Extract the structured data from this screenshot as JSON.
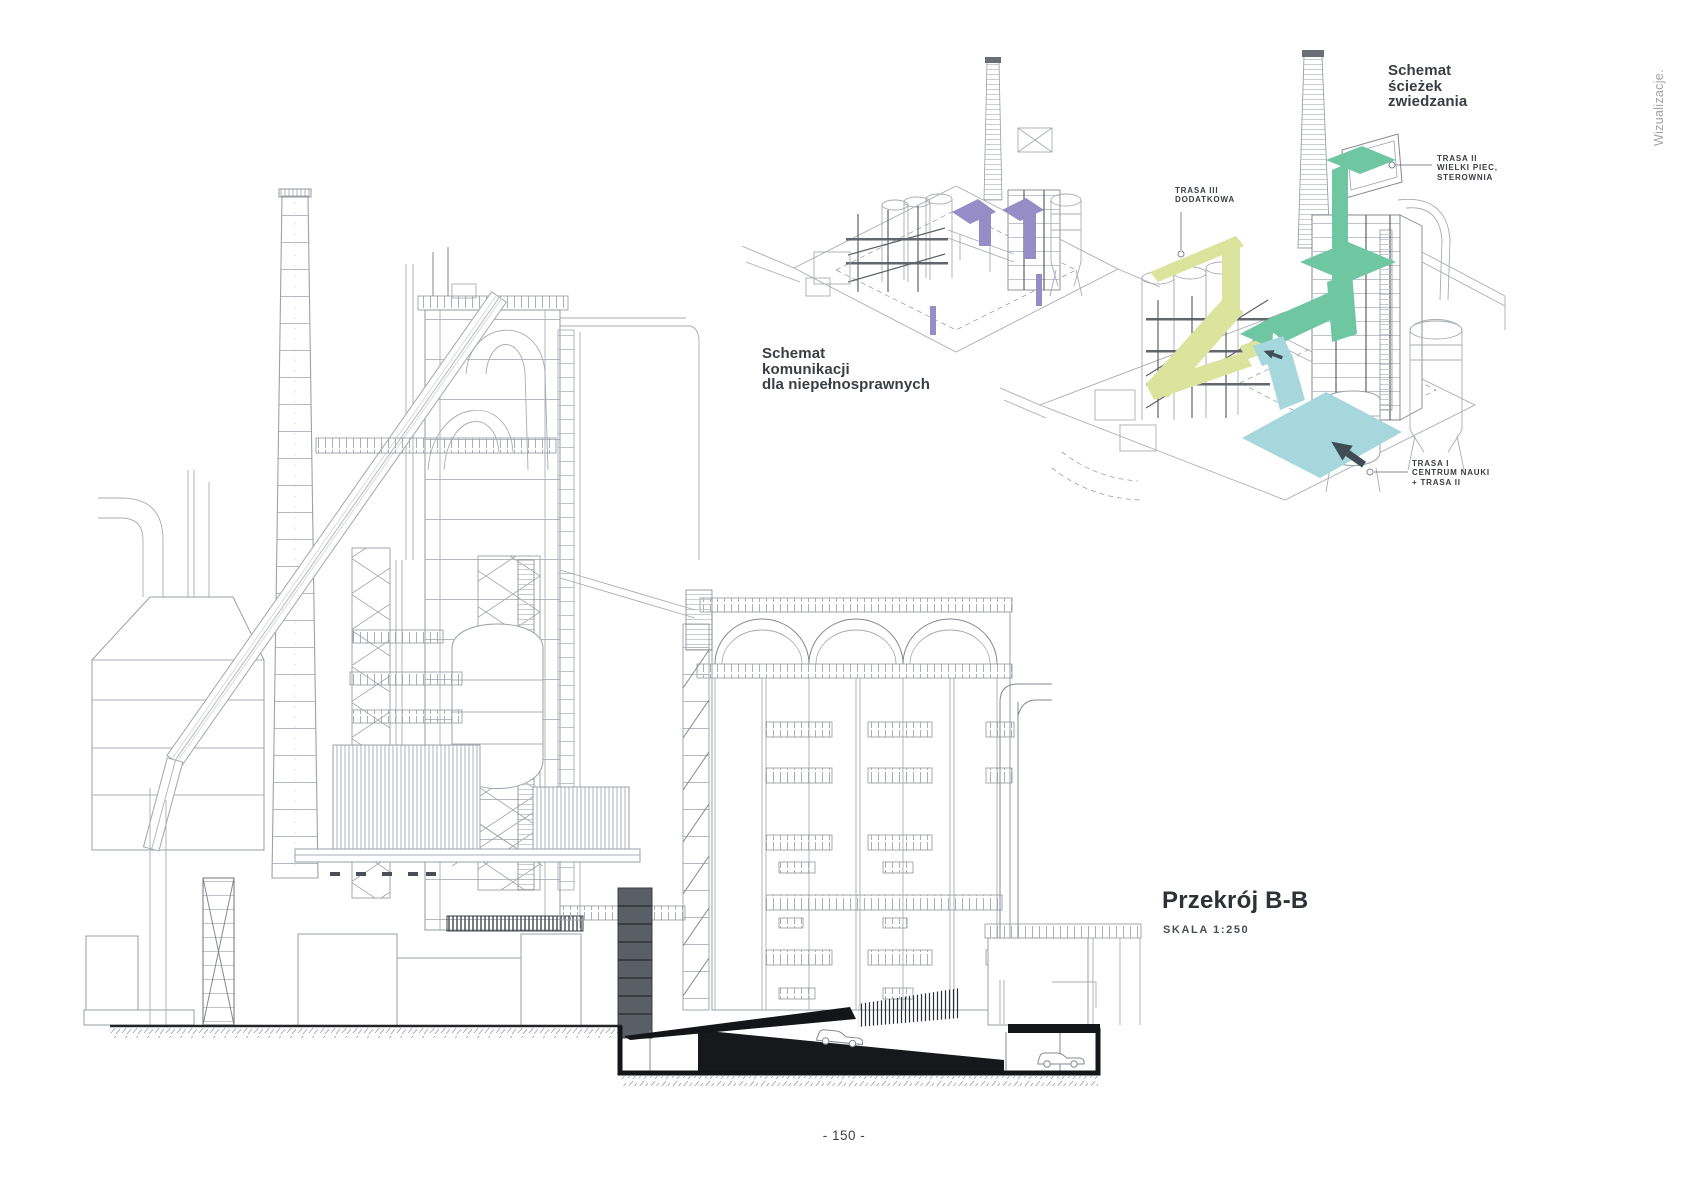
{
  "page": {
    "side_label": "Wizualizacje.",
    "page_number": "- 150 -",
    "background": "#ffffff"
  },
  "section_drawing": {
    "title": "Przekrój B-B",
    "scale_label": "SKALA 1:250"
  },
  "diagrams": {
    "accessibility": {
      "title_lines": [
        "Schemat",
        "komunikacji",
        "dla niepełnosprawnych"
      ],
      "accent_color": "#968dc6"
    },
    "tour": {
      "title_lines": [
        "Schemat",
        "ścieżek",
        "zwiedzania"
      ],
      "callouts": [
        {
          "id": "trasa-iii",
          "lines": [
            "TRASA III",
            "DODATKOWA"
          ],
          "color": "#dbe49c"
        },
        {
          "id": "trasa-ii",
          "lines": [
            "TRASA II",
            "WIELKI PIEC,",
            "STEROWNIA"
          ],
          "color": "#6fc6a2"
        },
        {
          "id": "trasa-i",
          "lines": [
            "TRASA I",
            "CENTRUM NAUKI",
            "+ TRASA II"
          ],
          "color": "#a6d7dd"
        }
      ]
    }
  },
  "colors": {
    "line_light": "#a8acb3",
    "line_dark": "#55585f",
    "ink": "#16181b",
    "route_purple": "#968dc6",
    "route_green": "#6fc6a2",
    "route_lime": "#dbe49c",
    "route_cyan": "#a6d7dd",
    "arrow_dark": "#3f4c55",
    "label_ink": "#3a3d43",
    "muted_gray": "#a2a3a8"
  }
}
